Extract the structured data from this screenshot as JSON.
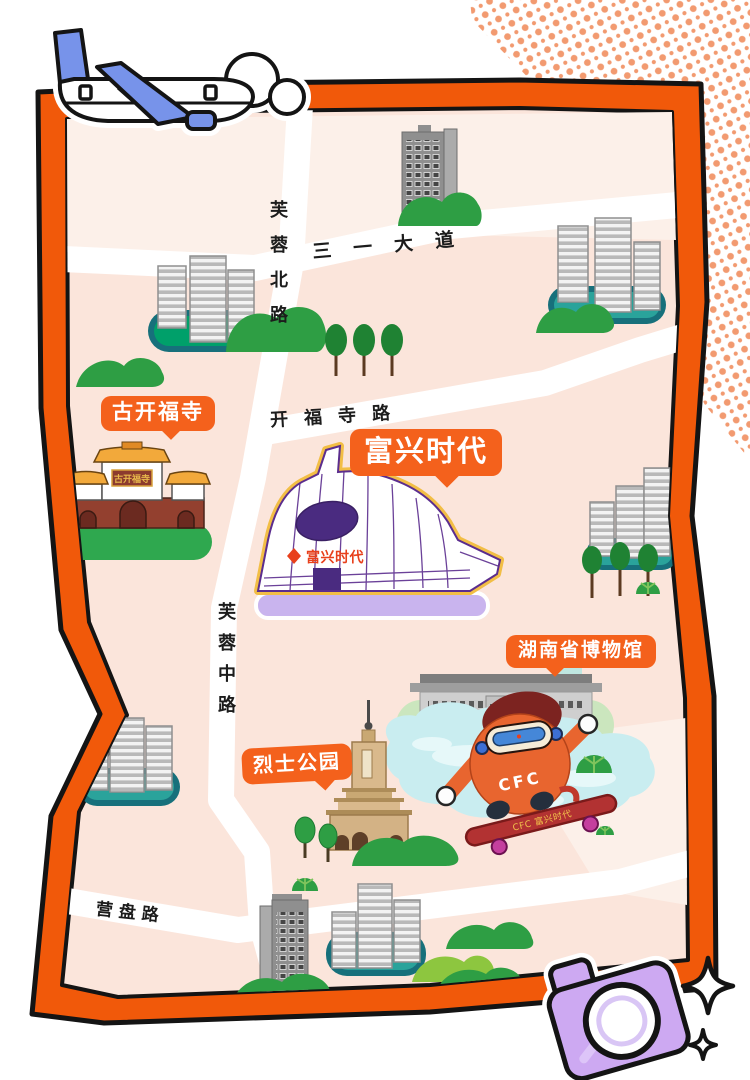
{
  "roads": {
    "sanyi_avenue": "三一大道",
    "furong_north_road": "芙蓉北路",
    "kaifu_temple_road": "开福寺路",
    "furong_middle_road": "芙蓉中路",
    "yingpan_road": "营盘路"
  },
  "landmark_bubbles": {
    "kaifu_temple": "古开福寺",
    "fuxing_times": "富兴时代",
    "hunan_museum": "湖南省博物馆",
    "martyrs_park": "烈士公园"
  },
  "signs": {
    "mall_facade_sign": "富兴时代",
    "temple_plaque": "古开福寺"
  },
  "mascot": {
    "belly_text": "CFC",
    "skateboard_text": "CFC 富兴时代"
  },
  "icons": {
    "airplane": "airplane-icon",
    "cloud": "cloud-icon",
    "camera": "camera-icon",
    "sparkle_large": "sparkle-icon",
    "sparkle_small": "sparkle-icon",
    "halftone": "halftone-dots"
  },
  "colors": {
    "frame_orange": "#F1590A",
    "bubble_orange": "#F4611C",
    "map_pink": "#FBE5DB",
    "map_pink_light": "#FCF0E9",
    "road_white": "#FFFFFF",
    "lake_blue": "#C9EDF0",
    "green_dark": "#2E9E44",
    "green_light": "#8DC63F",
    "platform_teal": "#17707B",
    "mall_purple": "#5B2D8E",
    "mall_platform_lavender": "#C9B4EE",
    "camera_lavender": "#CDA9F2",
    "plane_blue": "#7793EA",
    "mascot_orange": "#E8652F",
    "halftone_dot": "#F29A70"
  }
}
